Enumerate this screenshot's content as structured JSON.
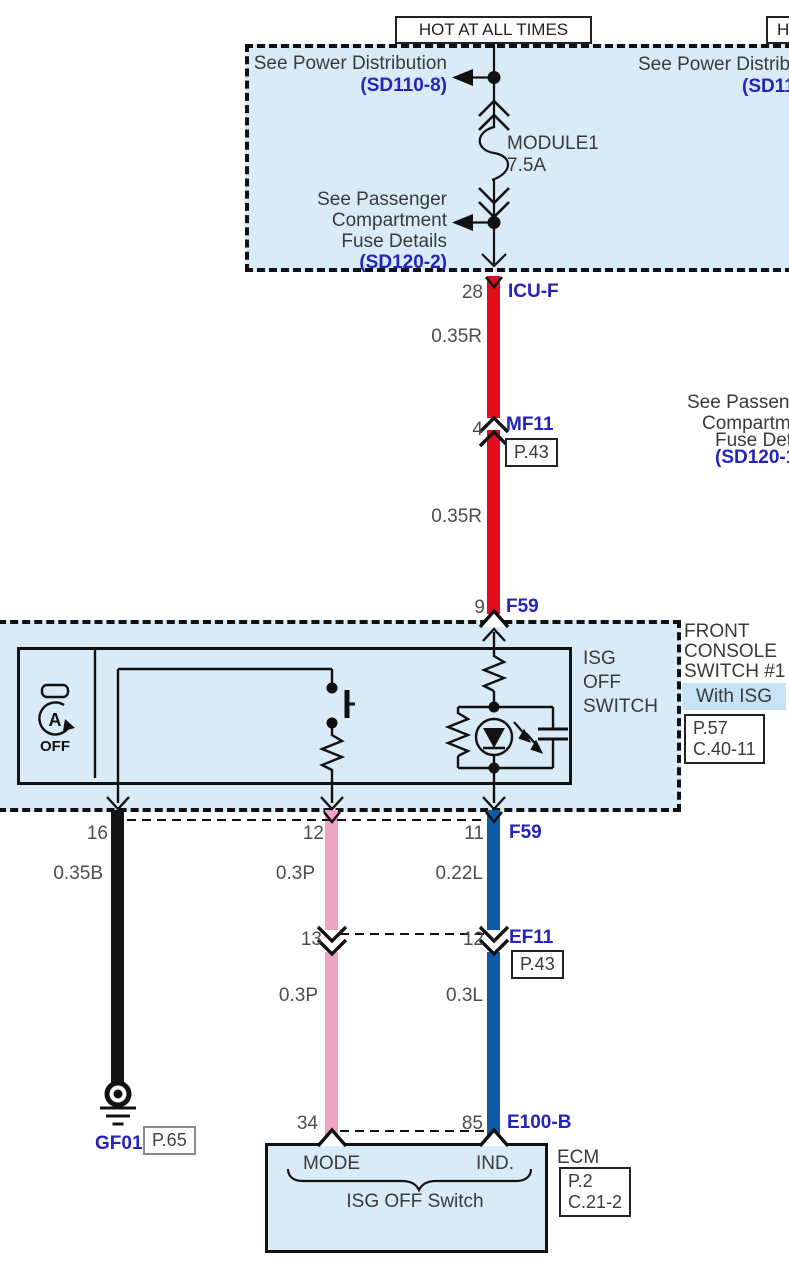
{
  "colors": {
    "wire_red": "#e30b1e",
    "wire_pink": "#efa3c5",
    "wire_blue": "#0f5aa8",
    "wire_black": "#141414",
    "ref_blue": "#2323bd",
    "panel_fill": "#d9ebf7",
    "highlight_fill": "#c6e4f5"
  },
  "top": {
    "hot_label": "HOT AT ALL TIMES",
    "hot_label_partial": "H",
    "see_power_distribution": "See Power Distribution",
    "sd110_ref": "(SD110-8)",
    "fuse_name": "MODULE1",
    "fuse_rating": "7.5A",
    "see_passenger_l1": "See Passenger",
    "see_passenger_l2": "Compartment",
    "see_passenger_l3": "Fuse Details",
    "sd120_ref": "(SD120-2)",
    "clip_power_1": "See Power Distribu",
    "clip_power_2": "(SD11"
  },
  "side_note": {
    "l1": "See Passeng",
    "l2": "Compartm",
    "l3": "Fuse Deta",
    "l4": "(SD120-1"
  },
  "icu": {
    "pin": "28",
    "name": "ICU-F",
    "gauge": "0.35R"
  },
  "mf11": {
    "pin": "4",
    "name": "MF11",
    "page": "P.43",
    "gauge": "0.35R"
  },
  "f59_in": {
    "pin": "9",
    "name": "F59"
  },
  "switch_box": {
    "title_l1": "FRONT",
    "title_l2": "CONSOLE",
    "title_l3": "SWITCH #1",
    "variant": "With ISG",
    "page": "P.57",
    "connector": "C.40-11",
    "label_l1": "ISG",
    "label_l2": "OFF",
    "label_l3": "SWITCH",
    "icon_a": "A",
    "icon_off": "OFF"
  },
  "f59_out": {
    "pin_ground": "16",
    "pin_mode": "12",
    "pin_ind": "11",
    "name": "F59",
    "gauge_ground": "0.35B",
    "gauge_mode": "0.3P",
    "gauge_ind": "0.22L"
  },
  "ef11": {
    "pin_left": "13",
    "pin_right": "12",
    "name": "EF11",
    "page": "P.43",
    "gauge_left": "0.3P",
    "gauge_right": "0.3L"
  },
  "e100b": {
    "pin_left": "34",
    "pin_right": "85",
    "name": "E100-B"
  },
  "ecm": {
    "name": "ECM",
    "page": "P.2",
    "connector": "C.21-2",
    "pin_label_left": "MODE",
    "pin_label_right": "IND.",
    "caption": "ISG OFF Switch"
  },
  "ground": {
    "name": "GF01",
    "page": "P.65"
  }
}
